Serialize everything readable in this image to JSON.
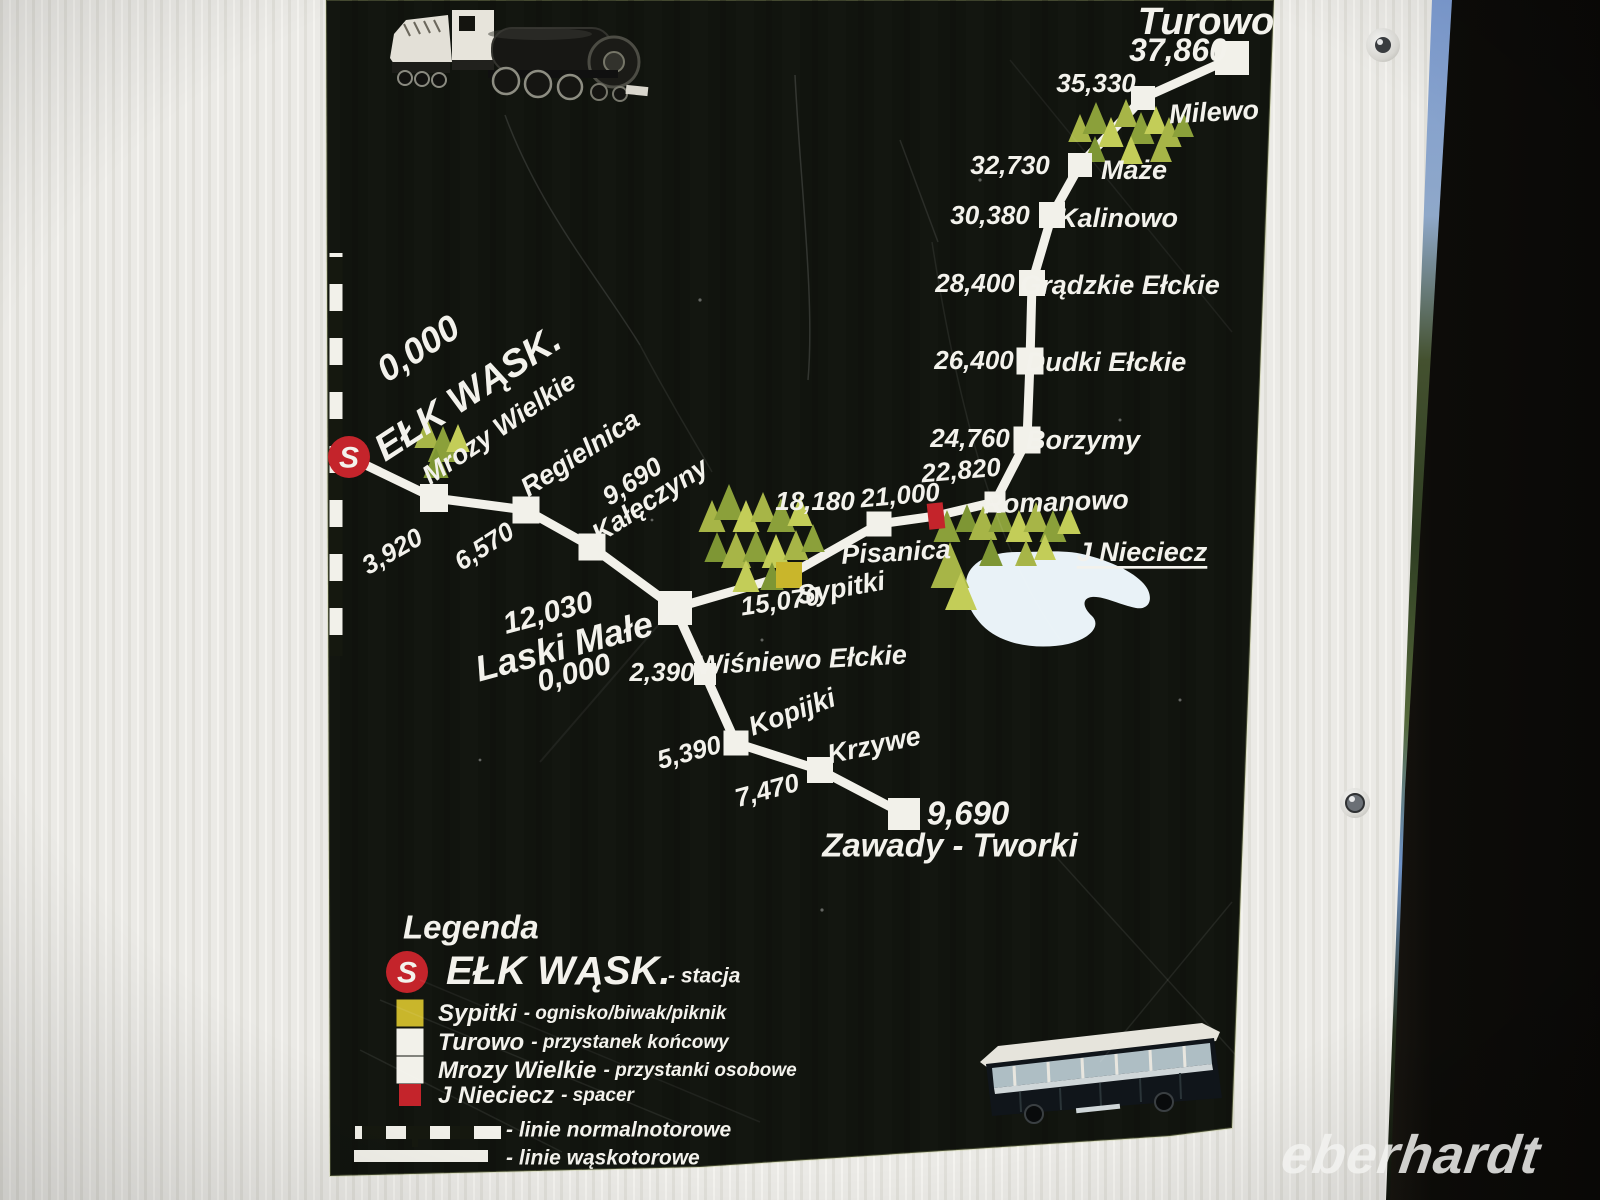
{
  "watermark": "eberhardt",
  "colors": {
    "sign_bg": "#11140e",
    "rail_white": "#f2f1ea",
    "text_white": "#f3f2ec",
    "red": "#c4242b",
    "yellow": "#c9b62b",
    "lake": "#e9f2f7",
    "tree_greens": [
      "#a7b547",
      "#8ba03a",
      "#c3cd58",
      "#7e9634"
    ]
  },
  "map": {
    "main_line": [
      [
        349,
        457
      ],
      [
        434,
        498
      ],
      [
        526,
        510
      ],
      [
        592,
        547
      ],
      [
        675,
        608
      ],
      [
        789,
        575
      ],
      [
        879,
        524
      ],
      [
        936,
        516
      ],
      [
        995,
        502
      ],
      [
        1027,
        440
      ],
      [
        1030,
        361
      ],
      [
        1032,
        283
      ],
      [
        1052,
        215
      ],
      [
        1080,
        165
      ],
      [
        1143,
        98
      ],
      [
        1232,
        58
      ]
    ],
    "branch_line": [
      [
        675,
        608
      ],
      [
        705,
        674
      ],
      [
        736,
        743
      ],
      [
        820,
        770
      ],
      [
        904,
        814
      ]
    ],
    "normal_gauge_line": {
      "x": 336,
      "y1": 253,
      "y2": 656
    },
    "lake": {
      "path": "M966,582 C968,562 990,552 1018,552 C1045,552 1068,549 1090,556 C1112,562 1140,574 1148,590 C1153,601 1148,610 1136,608 C1120,605 1104,596 1092,597 C1082,598 1082,607 1092,616 C1101,625 1092,638 1068,644 C1040,650 1002,646 982,625 C970,612 963,597 966,582 Z",
      "label": {
        "t": "J Nieciecz",
        "x": 1142,
        "y": 552,
        "r": 0,
        "s": 27,
        "u": 1
      }
    },
    "stations": [
      {
        "id": "elk",
        "type": "station-s",
        "node": [
          349,
          457,
          21
        ],
        "km_label": {
          "t": "0,000",
          "x": 418,
          "y": 348,
          "r": -33,
          "s": 36
        },
        "name_label": {
          "t": "EŁK WĄSK.",
          "x": 468,
          "y": 394,
          "r": -33,
          "s": 38
        }
      },
      {
        "id": "mrozy-wielkie",
        "type": "stop",
        "node": [
          434,
          498,
          28
        ],
        "km_label": {
          "t": "3,920",
          "x": 392,
          "y": 551,
          "r": -30,
          "s": 26
        },
        "name_label": {
          "t": "Mrozy Wielkie",
          "x": 499,
          "y": 428,
          "r": -34,
          "s": 27
        }
      },
      {
        "id": "regielnica",
        "type": "stop",
        "node": [
          526,
          510,
          27
        ],
        "km_label": {
          "t": "6,570",
          "x": 484,
          "y": 546,
          "r": -33,
          "s": 26
        },
        "name_label": {
          "t": "Regielnica",
          "x": 580,
          "y": 453,
          "r": -33,
          "s": 27
        }
      },
      {
        "id": "kaleczyny",
        "type": "stop",
        "node": [
          592,
          547,
          27
        ],
        "km_label": {
          "t": "9,690",
          "x": 632,
          "y": 481,
          "r": -33,
          "s": 26
        },
        "name_label": {
          "t": "Kałęczyny",
          "x": 650,
          "y": 500,
          "r": -33,
          "s": 27
        }
      },
      {
        "id": "laski-male",
        "type": "junction",
        "node": [
          675,
          608,
          34
        ],
        "km_label": {
          "t": "12,030",
          "x": 548,
          "y": 613,
          "r": -15,
          "s": 30
        },
        "name_label": {
          "t": "Laski Małe",
          "x": 564,
          "y": 646,
          "r": -15,
          "s": 36
        },
        "extra_label": {
          "t": "0,000",
          "x": 574,
          "y": 673,
          "r": -15,
          "s": 30
        }
      },
      {
        "id": "sypitki",
        "type": "picnic",
        "node": [
          789,
          575,
          26
        ],
        "km_label": {
          "t": "15,070",
          "x": 780,
          "y": 601,
          "r": -8,
          "s": 26
        },
        "name_label": {
          "t": "Sypitki",
          "x": 841,
          "y": 588,
          "r": -10,
          "s": 27
        }
      },
      {
        "id": "pisanica",
        "type": "stop",
        "node": [
          879,
          524,
          25
        ],
        "km_label": {
          "t": "18,180",
          "x": 815,
          "y": 501,
          "r": 0,
          "s": 26
        },
        "name_label": {
          "t": "Pisanica",
          "x": 896,
          "y": 552,
          "r": -3,
          "s": 27
        }
      },
      {
        "id": "j-nieciecz-walk",
        "type": "walk",
        "node": [
          936,
          516,
          24
        ],
        "km_label": {
          "t": "21,000",
          "x": 900,
          "y": 495,
          "r": -5,
          "s": 26
        }
      },
      {
        "id": "romanowo",
        "type": "stop",
        "node": [
          995,
          502,
          21
        ],
        "km_label": {
          "t": "22,820",
          "x": 961,
          "y": 470,
          "r": -5,
          "s": 26
        },
        "name_label": {
          "t": "Romanowo",
          "x": 1056,
          "y": 502,
          "r": -2,
          "s": 27
        }
      },
      {
        "id": "borzymy",
        "type": "stop",
        "node": [
          1027,
          440,
          27
        ],
        "km_label": {
          "t": "24,760",
          "x": 970,
          "y": 438,
          "r": 0,
          "s": 26
        },
        "name_label": {
          "t": "Borzymy",
          "x": 1083,
          "y": 440,
          "r": 0,
          "s": 27
        }
      },
      {
        "id": "dudki-elckie",
        "type": "stop",
        "node": [
          1030,
          361,
          27
        ],
        "km_label": {
          "t": "26,400",
          "x": 974,
          "y": 360,
          "r": 0,
          "s": 26
        },
        "name_label": {
          "t": "Dudki Ełckie",
          "x": 1106,
          "y": 362,
          "r": 0,
          "s": 27
        }
      },
      {
        "id": "gradzkie-elckie",
        "type": "stop",
        "node": [
          1032,
          283,
          26
        ],
        "km_label": {
          "t": "28,400",
          "x": 975,
          "y": 283,
          "r": 0,
          "s": 26
        },
        "name_label": {
          "t": "Grądzkie Ełckie",
          "x": 1120,
          "y": 285,
          "r": 0,
          "s": 27
        }
      },
      {
        "id": "kalinowo",
        "type": "stop",
        "node": [
          1052,
          215,
          26
        ],
        "km_label": {
          "t": "30,380",
          "x": 990,
          "y": 215,
          "r": 0,
          "s": 26
        },
        "name_label": {
          "t": "Kalinowo",
          "x": 1118,
          "y": 218,
          "r": 0,
          "s": 27
        }
      },
      {
        "id": "maze",
        "type": "stop",
        "node": [
          1080,
          165,
          24
        ],
        "km_label": {
          "t": "32,730",
          "x": 1010,
          "y": 165,
          "r": 0,
          "s": 26
        },
        "name_label": {
          "t": "Maże",
          "x": 1134,
          "y": 170,
          "r": 0,
          "s": 27
        }
      },
      {
        "id": "milewo",
        "type": "stop",
        "node": [
          1143,
          98,
          24
        ],
        "km_label": {
          "t": "35,330",
          "x": 1096,
          "y": 83,
          "r": 0,
          "s": 26
        },
        "name_label": {
          "t": "Milewo",
          "x": 1214,
          "y": 112,
          "r": -3,
          "s": 27
        }
      },
      {
        "id": "turowo",
        "type": "terminal",
        "node": [
          1232,
          58,
          34
        ],
        "km_label": {
          "t": "37,860",
          "x": 1178,
          "y": 50,
          "r": 0,
          "s": 32
        },
        "name_label": {
          "t": "Turowo",
          "x": 1206,
          "y": 22,
          "r": 0,
          "s": 38
        }
      },
      {
        "id": "wisniewo-elckie",
        "type": "stop",
        "node": [
          705,
          674,
          22
        ],
        "km_label": {
          "t": "2,390",
          "x": 662,
          "y": 672,
          "r": 0,
          "s": 26
        },
        "name_label": {
          "t": "Wiśniewo Ełckie",
          "x": 802,
          "y": 660,
          "r": -3,
          "s": 27
        }
      },
      {
        "id": "kopijki",
        "type": "stop",
        "node": [
          736,
          743,
          25
        ],
        "km_label": {
          "t": "5,390",
          "x": 689,
          "y": 752,
          "r": -15,
          "s": 26
        },
        "name_label": {
          "t": "Kopijki",
          "x": 792,
          "y": 712,
          "r": -20,
          "s": 27
        }
      },
      {
        "id": "krzywe",
        "type": "stop",
        "node": [
          820,
          770,
          26
        ],
        "km_label": {
          "t": "7,470",
          "x": 767,
          "y": 790,
          "r": -15,
          "s": 26
        },
        "name_label": {
          "t": "Krzywe",
          "x": 874,
          "y": 745,
          "r": -12,
          "s": 27
        }
      },
      {
        "id": "zawady-tworki",
        "type": "terminal",
        "node": [
          904,
          814,
          32
        ],
        "km_label": {
          "t": "9,690",
          "x": 968,
          "y": 813,
          "r": 0,
          "s": 33
        },
        "name_label": {
          "t": "Zawady - Tworki",
          "x": 950,
          "y": 845,
          "r": 0,
          "s": 33
        }
      }
    ],
    "trees": [
      [
        427,
        448,
        30,
        0
      ],
      [
        443,
        462,
        36,
        1
      ],
      [
        458,
        452,
        28,
        2
      ],
      [
        436,
        478,
        30,
        3
      ],
      [
        712,
        532,
        32,
        0
      ],
      [
        729,
        520,
        36,
        1
      ],
      [
        746,
        532,
        32,
        2
      ],
      [
        763,
        522,
        30,
        0
      ],
      [
        781,
        532,
        34,
        1
      ],
      [
        800,
        526,
        30,
        2
      ],
      [
        717,
        562,
        30,
        3
      ],
      [
        736,
        568,
        36,
        0
      ],
      [
        756,
        562,
        32,
        1
      ],
      [
        776,
        568,
        34,
        2
      ],
      [
        796,
        560,
        30,
        0
      ],
      [
        813,
        552,
        28,
        1
      ],
      [
        746,
        592,
        32,
        2
      ],
      [
        772,
        590,
        28,
        3
      ],
      [
        947,
        542,
        32,
        1
      ],
      [
        950,
        588,
        46,
        0
      ],
      [
        961,
        610,
        38,
        2
      ],
      [
        967,
        532,
        28,
        3
      ],
      [
        983,
        540,
        34,
        0
      ],
      [
        1001,
        532,
        30,
        1
      ],
      [
        1019,
        542,
        32,
        2
      ],
      [
        1036,
        532,
        30,
        0
      ],
      [
        1053,
        542,
        32,
        1
      ],
      [
        1069,
        534,
        28,
        2
      ],
      [
        991,
        566,
        28,
        3
      ],
      [
        1026,
        566,
        26,
        0
      ],
      [
        1045,
        560,
        26,
        2
      ],
      [
        1080,
        142,
        28,
        0
      ],
      [
        1096,
        134,
        32,
        1
      ],
      [
        1111,
        147,
        30,
        2
      ],
      [
        1126,
        127,
        28,
        0
      ],
      [
        1141,
        144,
        32,
        1
      ],
      [
        1156,
        134,
        28,
        2
      ],
      [
        1169,
        147,
        30,
        0
      ],
      [
        1183,
        137,
        26,
        1
      ],
      [
        1095,
        162,
        26,
        3
      ],
      [
        1131,
        164,
        28,
        2
      ],
      [
        1161,
        162,
        26,
        0
      ]
    ]
  },
  "legend": {
    "title": "Legenda",
    "station": {
      "symbol": "S",
      "name": "EŁK WĄSK.",
      "desc": "- stacja"
    },
    "items": [
      {
        "color": "#c9b62b",
        "name": "Sypitki",
        "desc": "- ognisko/biwak/piknik"
      },
      {
        "color": "#f2f1ea",
        "name": "Turowo",
        "desc": "- przystanek końcowy"
      },
      {
        "color": "#f2f1ea",
        "name": "Mrozy Wielkie",
        "desc": "- przystanki osobowe"
      },
      {
        "color": "#c4242b",
        "name": "J Nieciecz",
        "desc": "- spacer"
      }
    ],
    "lines": [
      {
        "style": "normal",
        "desc": "- linie normalnotorowe"
      },
      {
        "style": "narrow",
        "desc": "- linie wąskotorowe"
      }
    ]
  }
}
